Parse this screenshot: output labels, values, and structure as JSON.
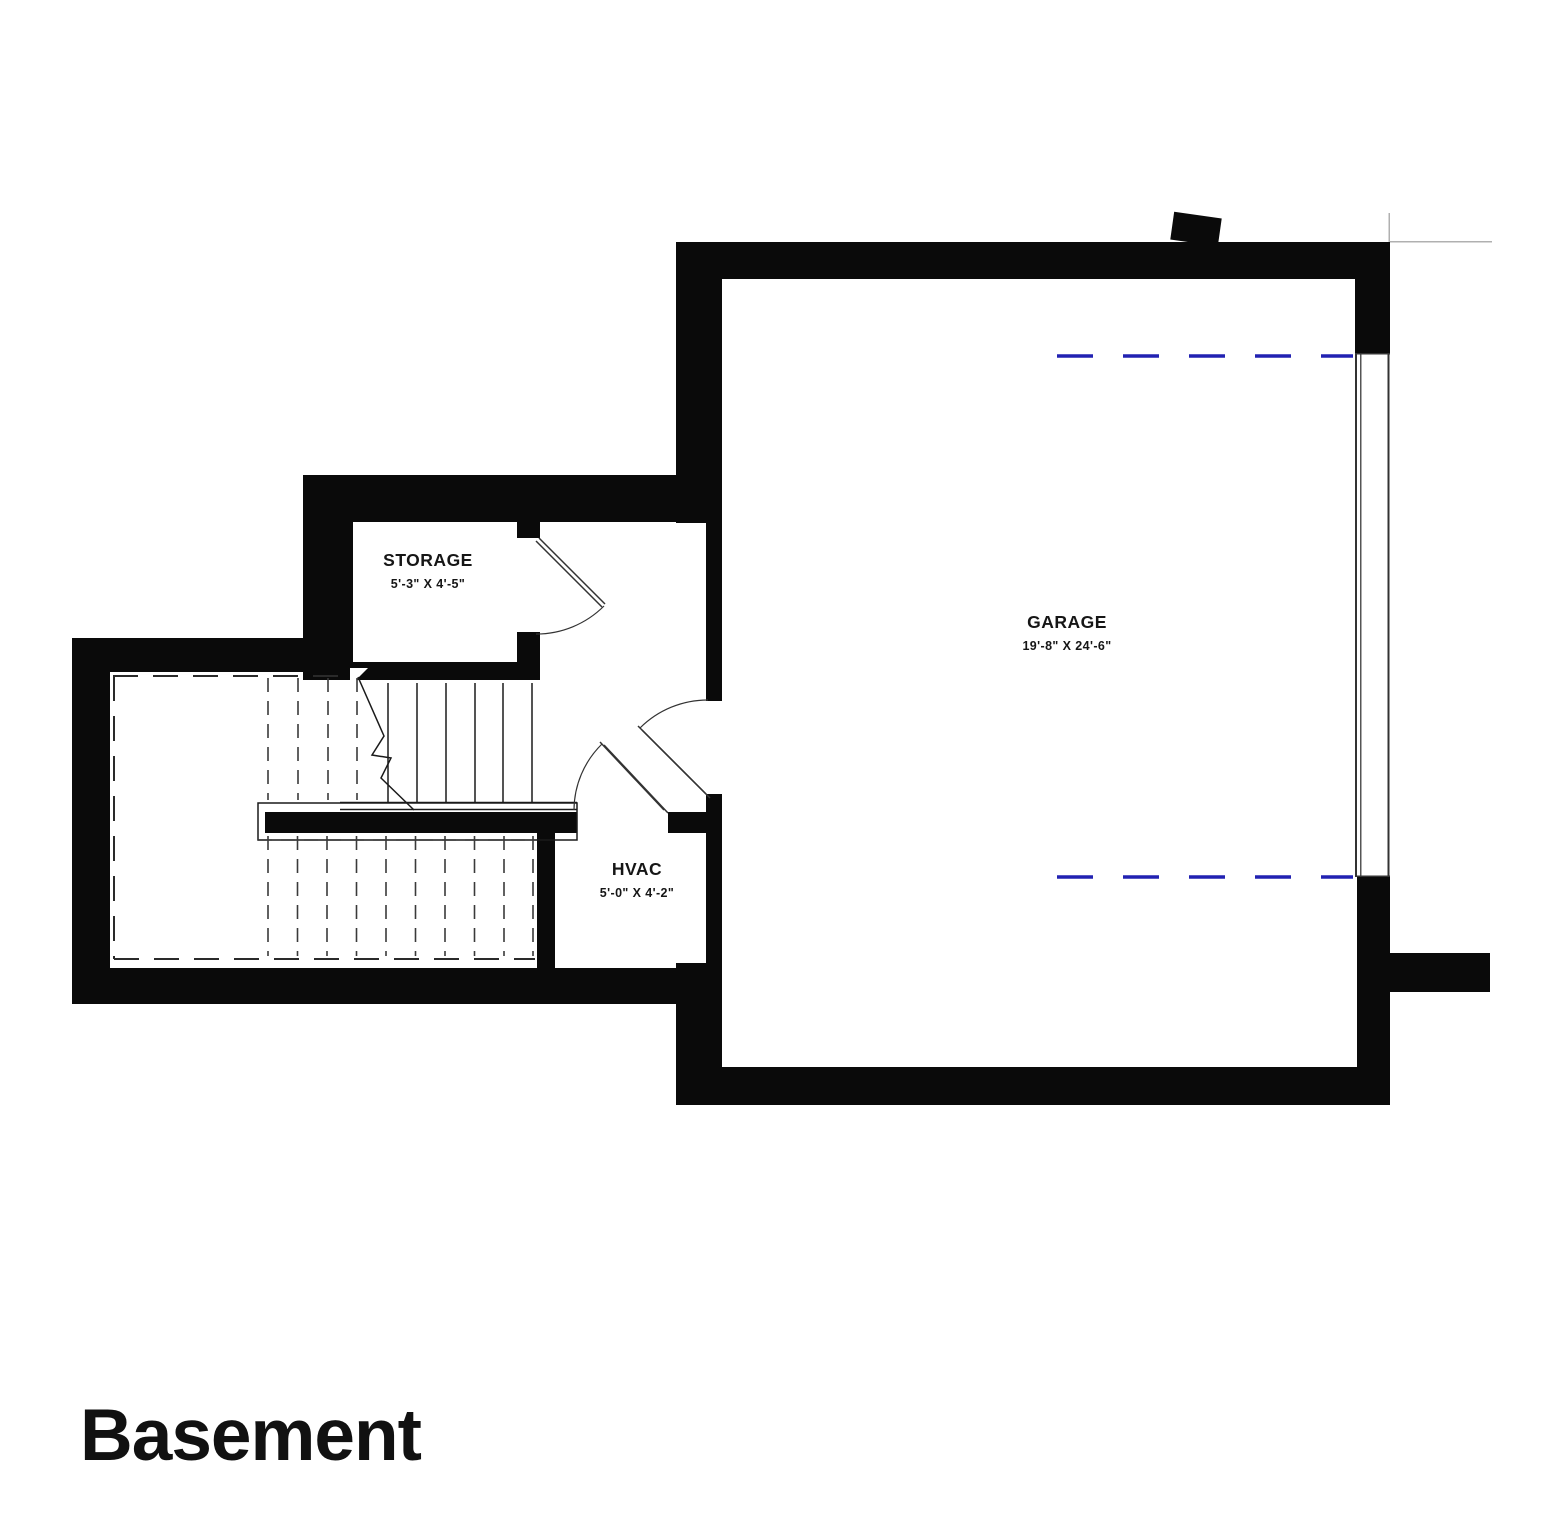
{
  "title": "Basement",
  "rooms": [
    {
      "id": "storage",
      "name": "STORAGE",
      "dims": "5'-3\" X 4'-5\""
    },
    {
      "id": "hvac",
      "name": "HVAC",
      "dims": "5'-0\" X 4'-2\""
    },
    {
      "id": "garage",
      "name": "GARAGE",
      "dims": "19'-8\" X 24'-6\""
    }
  ],
  "colors": {
    "wall": "#0a0a0a",
    "line": "#1a1a1a",
    "thin_line": "#333333",
    "dashed_line": "#3a3a3a",
    "garage_door_track_dash": "#2222b2",
    "construction_line": "#b0b0b0",
    "background": "#ffffff"
  },
  "features": {
    "stairs": "stairs-with-break-line",
    "window": "garage-right-wall-window",
    "doors": [
      "storage-door",
      "hallway-garage-door",
      "hvac-door"
    ],
    "blue_dashes": "overhead-garage-door-tracks"
  }
}
